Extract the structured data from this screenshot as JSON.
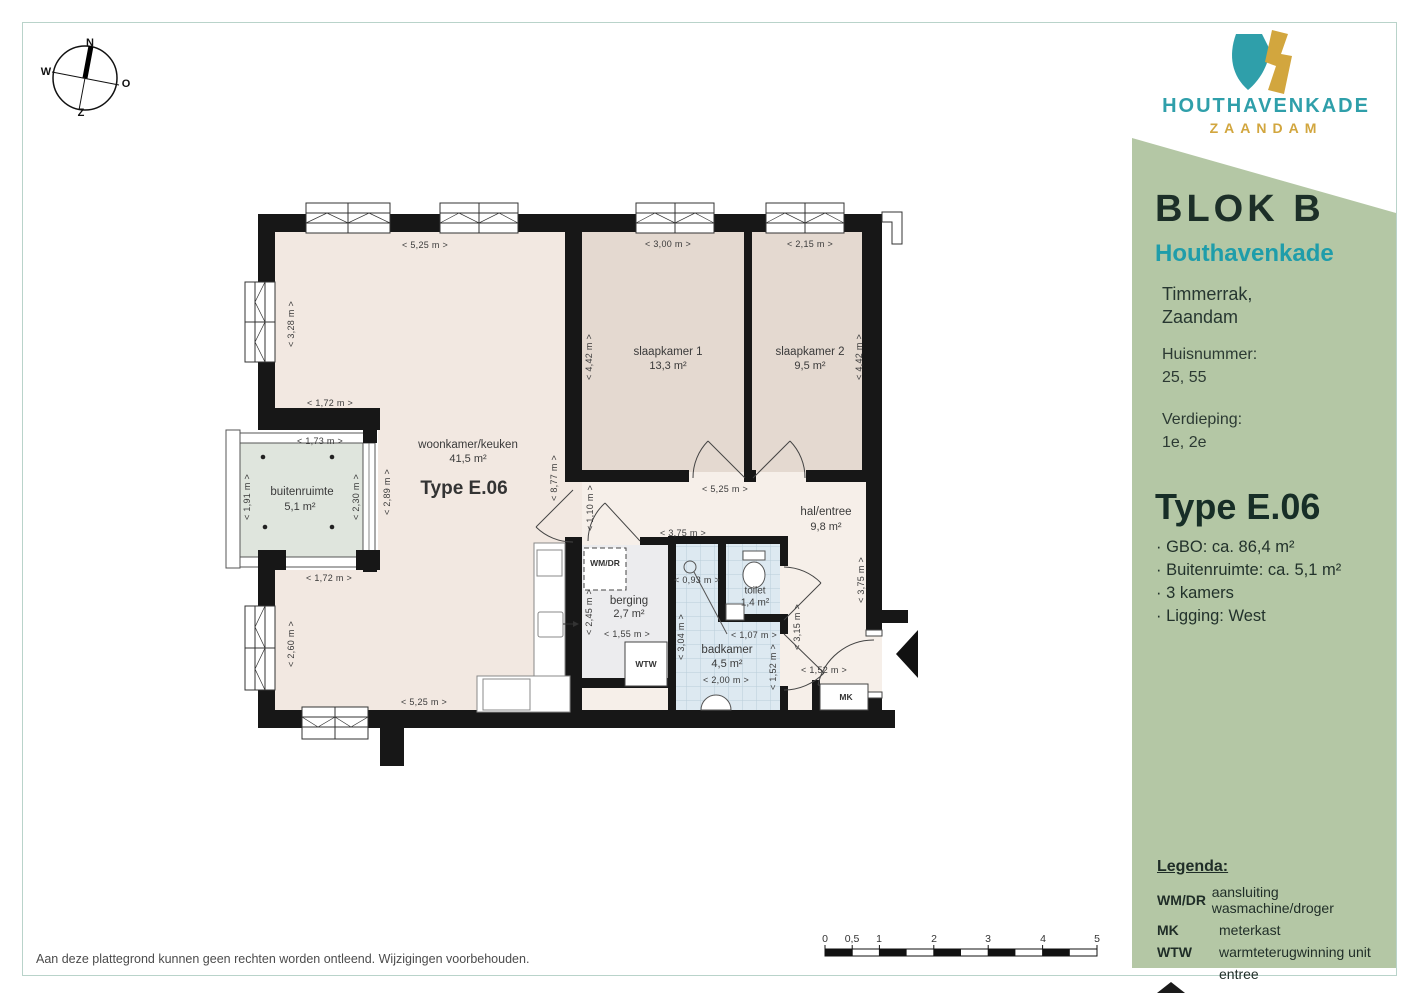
{
  "colors": {
    "brand_teal": "#2f9faa",
    "brand_gold": "#d2a63e",
    "sidebar_green": "#b4c7a5",
    "wall": "#171717",
    "floor_living": "#f2e8e1",
    "floor_bedroom": "#e4d9d0",
    "floor_hall": "#f6efe9",
    "floor_storage": "#ececee",
    "floor_bath": "#dde9f1",
    "floor_balcony": "#dfe5dd",
    "minimap_highlight": "#f0a73b"
  },
  "compass": {
    "n": "N",
    "o": "O",
    "z": "Z",
    "w": "W"
  },
  "logo": {
    "name": "HOUTHAVENKADE",
    "city": "ZAANDAM"
  },
  "sidebar": {
    "block": "BLOK B",
    "project": "Houthavenkade",
    "location_line1": "Timmerrak,",
    "location_line2": "Zaandam",
    "huisnummer_label": "Huisnummer:",
    "huisnummer": "25, 55",
    "verdieping_label": "Verdieping:",
    "verdieping": "1e, 2e",
    "type_title": "Type E.06",
    "specs": [
      "· GBO: ca. 86,4 m²",
      "· Buitenruimte: ca. 5,1 m²",
      "· 3 kamers",
      "· Ligging: West"
    ],
    "legend": {
      "title": "Legenda:",
      "rows": [
        {
          "key": "WM/DR",
          "desc": "aansluiting wasmachine/droger"
        },
        {
          "key": "MK",
          "desc": "meterkast"
        },
        {
          "key": "WTW",
          "desc": "warmteterugwinning unit"
        },
        {
          "key": "",
          "icon": "entree-triangle",
          "desc": "entree"
        }
      ]
    }
  },
  "plan": {
    "type_label": "Type E.06",
    "rooms": {
      "woonkamer": {
        "name": "woonkamer/keuken",
        "area": "41,5 m²"
      },
      "slaapkamer1": {
        "name": "slaapkamer 1",
        "area": "13,3 m²"
      },
      "slaapkamer2": {
        "name": "slaapkamer 2",
        "area": "9,5 m²"
      },
      "buitenruimte": {
        "name": "buitenruimte",
        "area": "5,1 m²"
      },
      "hal": {
        "name": "hal/entree",
        "area": "9,8 m²"
      },
      "berging": {
        "name": "berging",
        "area": "2,7 m²"
      },
      "badkamer": {
        "name": "badkamer",
        "area": "4,5 m²"
      },
      "toilet": {
        "name": "toilet",
        "area": "1,4 m²"
      }
    },
    "fixtures": {
      "wmdr": "WM/DR",
      "wtw": "WTW",
      "mk": "MK"
    },
    "dims_h": [
      "< 5,25 m >",
      "< 3,00 m >",
      "< 2,15 m >",
      "< 1,72 m >",
      "< 1,73 m >",
      "< 1,72 m >",
      "< 5,25 m >",
      "< 5,25 m >",
      "< 3,75 m >",
      "< 1,55 m >",
      "< 0,93 m >",
      "< 1,07 m >",
      "< 2,00 m >",
      "< 1,52 m >"
    ],
    "dims_v": [
      "< 3,28 m >",
      "< 1,91 m >",
      "< 2,30 m >",
      "< 2,89 m >",
      "< 2,60 m >",
      "< 8,77 m >",
      "< 4,42 m >",
      "< 4,42 m >",
      "< 1,10 m >",
      "< 2,45 m >",
      "< 3,04 m >",
      "< 1,52 m >",
      "< 3,75 m >",
      "< 3,15 m >"
    ]
  },
  "scalebar": {
    "labels": [
      "0",
      "0,5",
      "1",
      "2",
      "3",
      "4",
      "5"
    ]
  },
  "footer": {
    "disclaimer": "Aan deze plattegrond kunnen geen rechten worden ontleend. Wijzigingen voorbehouden."
  }
}
